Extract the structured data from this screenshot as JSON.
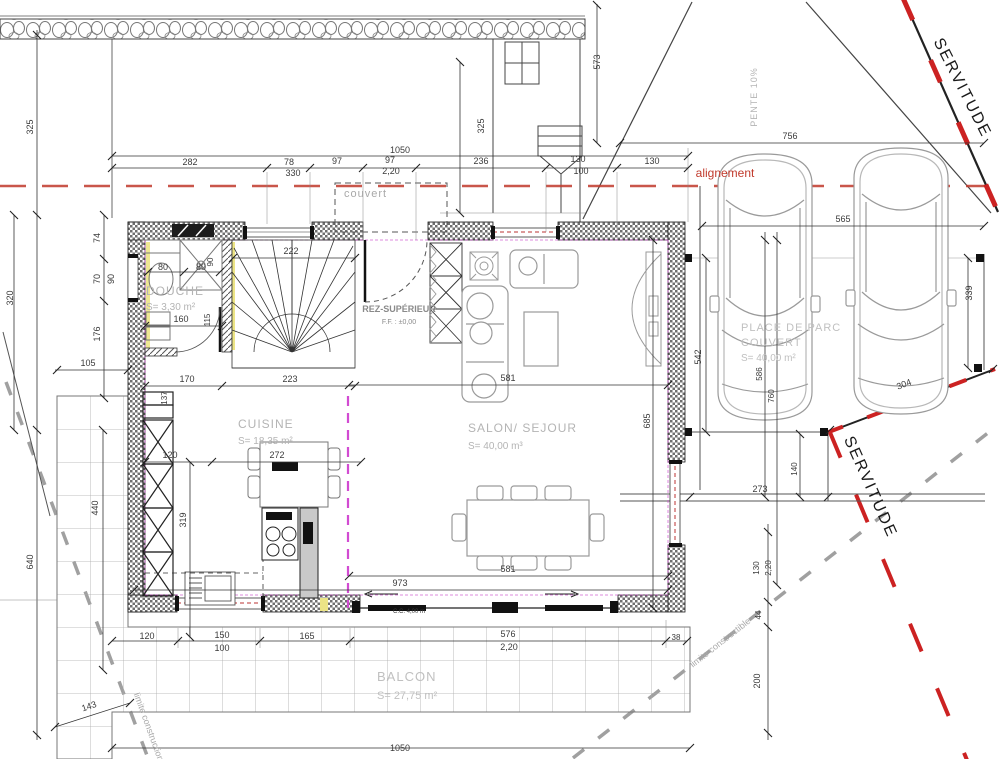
{
  "title": "Plan rez-supérieur",
  "colors": {
    "dim_text": "#3a3a3a",
    "room_text": "#b4b4b4",
    "alignement_red": "#c0392b",
    "servitude_red": "#cc2222",
    "magenta": "#d24bd2",
    "limite_gray": "#a9a9a9",
    "wall_dark": "#1a1a1a",
    "furniture_gray": "#9a9a9a"
  },
  "labels": [
    {
      "n": "dim-top-1050",
      "t": "1050",
      "x": 400,
      "y": 153
    },
    {
      "n": "dim-282",
      "t": "282",
      "x": 190,
      "y": 165
    },
    {
      "n": "dim-78",
      "t": "78",
      "x": 289,
      "y": 165
    },
    {
      "n": "dim-330",
      "t": "330",
      "x": 293,
      "y": 176
    },
    {
      "n": "dim-97a",
      "t": "97",
      "x": 337,
      "y": 164
    },
    {
      "n": "dim-97b",
      "t": "97",
      "x": 390,
      "y": 163
    },
    {
      "n": "dim-2-20a",
      "t": "2,20",
      "x": 391,
      "y": 174
    },
    {
      "n": "dim-236",
      "t": "236",
      "x": 481,
      "y": 164
    },
    {
      "n": "dim-130a",
      "t": "130",
      "x": 578,
      "y": 162
    },
    {
      "n": "dim-100a",
      "t": "100",
      "x": 581,
      "y": 174
    },
    {
      "n": "dim-130b",
      "t": "130",
      "x": 652,
      "y": 164
    },
    {
      "n": "label-alignement",
      "t": "alignement",
      "x": 725,
      "y": 177,
      "c": "#c0392b",
      "s": 12
    },
    {
      "n": "dim-756",
      "t": "756",
      "x": 790,
      "y": 139
    },
    {
      "n": "dim-325b",
      "t": "325",
      "x": 484,
      "y": 126,
      "r": -90
    },
    {
      "n": "dim-573",
      "t": "573",
      "x": 600,
      "y": 62,
      "r": -90
    },
    {
      "n": "label-couvert",
      "t": "couvert",
      "x": 344,
      "y": 197,
      "c": "#a9a9a9",
      "s": 11,
      "a": "start",
      "ls": 1
    },
    {
      "n": "label-pente",
      "t": "PENTE 10%",
      "x": 757,
      "y": 97,
      "r": -90,
      "c": "#b4b4b4",
      "s": 9,
      "ls": 1
    },
    {
      "n": "dim-325a",
      "t": "325",
      "x": 33,
      "y": 127,
      "r": -90
    },
    {
      "n": "dim-320",
      "t": "320",
      "x": 13,
      "y": 298,
      "r": -90
    },
    {
      "n": "dim-640",
      "t": "640",
      "x": 33,
      "y": 562,
      "r": -90
    },
    {
      "n": "dim-74",
      "t": "74",
      "x": 100,
      "y": 238,
      "r": -90
    },
    {
      "n": "dim-70",
      "t": "70",
      "x": 100,
      "y": 279,
      "r": -90
    },
    {
      "n": "dim-90a",
      "t": "90",
      "x": 114,
      "y": 279,
      "r": -90
    },
    {
      "n": "dim-176",
      "t": "176",
      "x": 100,
      "y": 334,
      "r": -90
    },
    {
      "n": "dim-105",
      "t": "105",
      "x": 88,
      "y": 366
    },
    {
      "n": "dim-440",
      "t": "440",
      "x": 98,
      "y": 508,
      "r": -90
    },
    {
      "n": "dim-143",
      "t": "143",
      "x": 90,
      "y": 709,
      "r": -19
    },
    {
      "n": "room-douche",
      "t": "DOUCHE",
      "x": 146,
      "y": 295,
      "c": "#b4b4b4",
      "s": 12,
      "a": "start",
      "ls": 1
    },
    {
      "n": "room-douche-area",
      "t": "S= 3,30 m²",
      "x": 146,
      "y": 310,
      "c": "#b4b4b4",
      "s": 10,
      "a": "start"
    },
    {
      "n": "dim-80a",
      "t": "80",
      "x": 163,
      "y": 270
    },
    {
      "n": "dim-80b",
      "t": "80",
      "x": 201,
      "y": 270
    },
    {
      "n": "dim-90b",
      "t": "90",
      "x": 213,
      "y": 262,
      "r": -90,
      "s": 8
    },
    {
      "n": "dim-160",
      "t": "160",
      "x": 181,
      "y": 322
    },
    {
      "n": "dim-115",
      "t": "115",
      "x": 210,
      "y": 320,
      "r": -90,
      "s": 8
    },
    {
      "n": "dim-222",
      "t": "222",
      "x": 291,
      "y": 254
    },
    {
      "n": "dim-170",
      "t": "170",
      "x": 187,
      "y": 382
    },
    {
      "n": "dim-223",
      "t": "223",
      "x": 290,
      "y": 382
    },
    {
      "n": "dim-137",
      "t": "137",
      "x": 167,
      "y": 398,
      "r": -90,
      "s": 8
    },
    {
      "n": "label-rez",
      "t": "REZ-SUPÉRIEUR",
      "x": 399,
      "y": 312,
      "c": "#8a8a8a",
      "s": 9,
      "w": "bold"
    },
    {
      "n": "label-rez-ff",
      "t": "F.F. : ±0,00",
      "x": 399,
      "y": 324,
      "c": "#8a8a8a",
      "s": 7
    },
    {
      "n": "room-cuisine",
      "t": "CUISINE",
      "x": 238,
      "y": 428,
      "c": "#b4b4b4",
      "s": 12,
      "a": "start",
      "ls": 1
    },
    {
      "n": "room-cuisine-area",
      "t": "S= 18,35 m²",
      "x": 238,
      "y": 444,
      "c": "#b4b4b4",
      "s": 10,
      "a": "start"
    },
    {
      "n": "dim-120k",
      "t": "120",
      "x": 170,
      "y": 458
    },
    {
      "n": "dim-272",
      "t": "272",
      "x": 277,
      "y": 458
    },
    {
      "n": "dim-319",
      "t": "319",
      "x": 186,
      "y": 520,
      "r": -90
    },
    {
      "n": "room-salon",
      "t": "SALON/ SEJOUR",
      "x": 468,
      "y": 432,
      "c": "#b4b4b4",
      "s": 12,
      "a": "start",
      "ls": 1
    },
    {
      "n": "room-salon-area",
      "t": "S= 40,00 m³",
      "x": 468,
      "y": 449,
      "c": "#b4b4b4",
      "s": 10,
      "a": "start"
    },
    {
      "n": "dim-581a",
      "t": "581",
      "x": 508,
      "y": 381
    },
    {
      "n": "dim-685",
      "t": "685",
      "x": 650,
      "y": 421,
      "r": -90
    },
    {
      "n": "dim-581b",
      "t": "581",
      "x": 508,
      "y": 572
    },
    {
      "n": "dim-973",
      "t": "973",
      "x": 400,
      "y": 586
    },
    {
      "n": "label-cc",
      "t": "C.C. 4,00 m",
      "x": 393,
      "y": 613,
      "s": 6,
      "a": "start"
    },
    {
      "n": "dim-576",
      "t": "576",
      "x": 508,
      "y": 637
    },
    {
      "n": "dim-2-20b",
      "t": "2,20",
      "x": 509,
      "y": 650
    },
    {
      "n": "dim-38a",
      "t": "38",
      "x": 676,
      "y": 640,
      "s": 8
    },
    {
      "n": "dim-120b",
      "t": "120",
      "x": 147,
      "y": 639
    },
    {
      "n": "dim-150",
      "t": "150",
      "x": 222,
      "y": 638
    },
    {
      "n": "dim-100b",
      "t": "100",
      "x": 222,
      "y": 651
    },
    {
      "n": "dim-165",
      "t": "165",
      "x": 307,
      "y": 639
    },
    {
      "n": "room-balcon",
      "t": "BALCON",
      "x": 377,
      "y": 681,
      "c": "#c0c0c0",
      "s": 13,
      "a": "start",
      "ls": 1
    },
    {
      "n": "room-balcon-area",
      "t": "S= 27,75 m²",
      "x": 377,
      "y": 699,
      "c": "#c0c0c0",
      "s": 11,
      "a": "start"
    },
    {
      "n": "dim-bottom-1050",
      "t": "1050",
      "x": 400,
      "y": 751
    },
    {
      "n": "room-parc-1",
      "t": "PLACE DE PARC",
      "x": 741,
      "y": 331,
      "c": "#c0c0c0",
      "s": 11,
      "a": "start",
      "ls": 1
    },
    {
      "n": "room-parc-2",
      "t": "COUVERT",
      "x": 741,
      "y": 346,
      "c": "#c0c0c0",
      "s": 11,
      "a": "start",
      "ls": 1
    },
    {
      "n": "room-parc-area",
      "t": "S= 40,00 m²",
      "x": 741,
      "y": 361,
      "c": "#c0c0c0",
      "s": 10,
      "a": "start"
    },
    {
      "n": "dim-565",
      "t": "565",
      "x": 843,
      "y": 222
    },
    {
      "n": "dim-542",
      "t": "542",
      "x": 701,
      "y": 357,
      "r": -90
    },
    {
      "n": "dim-586",
      "t": "586",
      "x": 762,
      "y": 374,
      "r": -90,
      "s": 8
    },
    {
      "n": "dim-760",
      "t": "760",
      "x": 774,
      "y": 396,
      "r": -90,
      "s": 8
    },
    {
      "n": "dim-339",
      "t": "339",
      "x": 972,
      "y": 293,
      "r": -90
    },
    {
      "n": "dim-304",
      "t": "304",
      "x": 905,
      "y": 387,
      "r": -21
    },
    {
      "n": "dim-273",
      "t": "273",
      "x": 760,
      "y": 492
    },
    {
      "n": "dim-140",
      "t": "140",
      "x": 797,
      "y": 469,
      "r": -90,
      "s": 8
    },
    {
      "n": "dim-130r",
      "t": "130",
      "x": 759,
      "y": 568,
      "r": -90,
      "s": 8
    },
    {
      "n": "dim-2-20c",
      "t": "2,20",
      "x": 771,
      "y": 568,
      "r": -90,
      "s": 8
    },
    {
      "n": "dim-44",
      "t": "44",
      "x": 761,
      "y": 615,
      "r": -90,
      "s": 8
    },
    {
      "n": "dim-200",
      "t": "200",
      "x": 760,
      "y": 681,
      "r": -90
    },
    {
      "n": "label-servitude-top",
      "t": "SERVITUDE",
      "x": 958,
      "y": 90,
      "r": 63,
      "s": 16,
      "c": "#1a1a1a",
      "ls": 2
    },
    {
      "n": "label-servitude-bottom",
      "t": "SERVITUDE",
      "x": 866,
      "y": 489,
      "r": 66,
      "s": 16,
      "c": "#1a1a1a",
      "ls": 2
    },
    {
      "n": "label-limite-right",
      "t": "limite constructible",
      "x": 722,
      "y": 645,
      "r": -38,
      "c": "#a9a9a9",
      "s": 9
    },
    {
      "n": "label-limite-left",
      "t": "limite construction",
      "x": 146,
      "y": 728,
      "r": 70,
      "c": "#a9a9a9",
      "s": 9
    }
  ]
}
